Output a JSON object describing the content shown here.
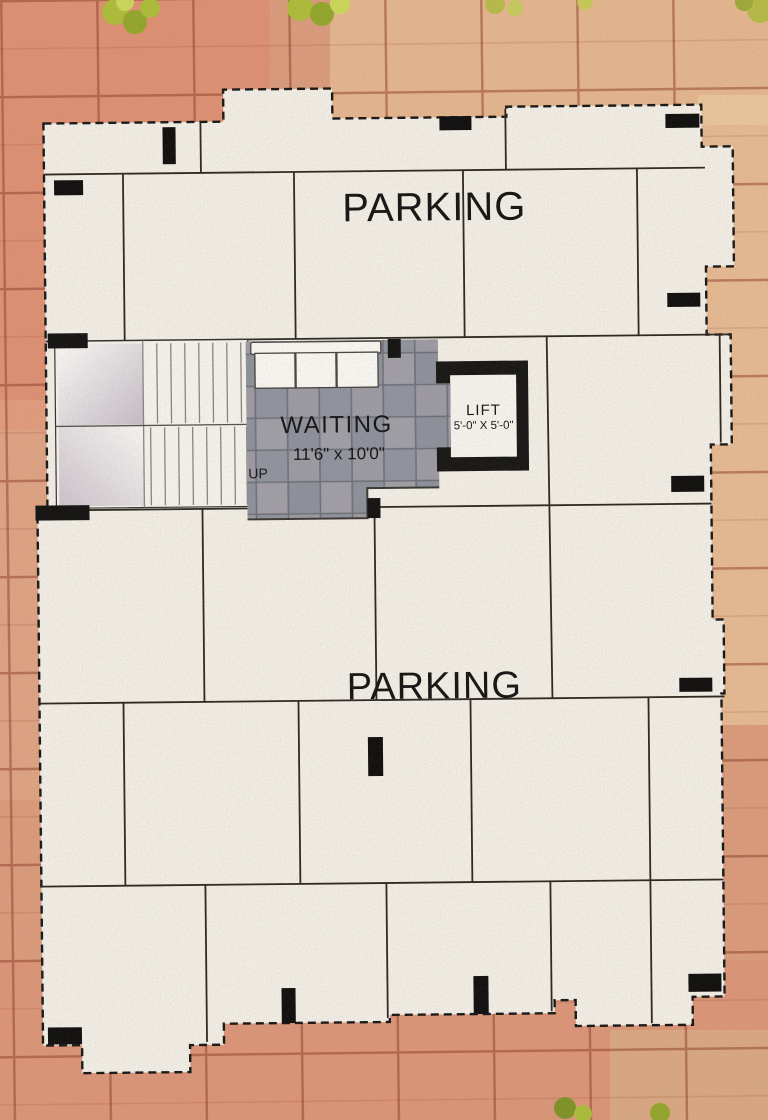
{
  "plan": {
    "type": "parking-floor-plan",
    "areas": {
      "parking_top": "PARKING",
      "parking_middle": "PARKING",
      "waiting": "WAITING",
      "waiting_dims": "11'6\" x 10'0\"",
      "stairs_up": "UP",
      "lift": "LIFT",
      "lift_dims": "5'-0\" X 5'-0\""
    },
    "colors": {
      "paving": "#dc9c7d",
      "paving_line": "#8e3c26",
      "plan_fill": "#f4f1ea",
      "wall": "#111111",
      "waiting_tile": "#9599a1",
      "plant_green": "#aebe3a"
    }
  }
}
